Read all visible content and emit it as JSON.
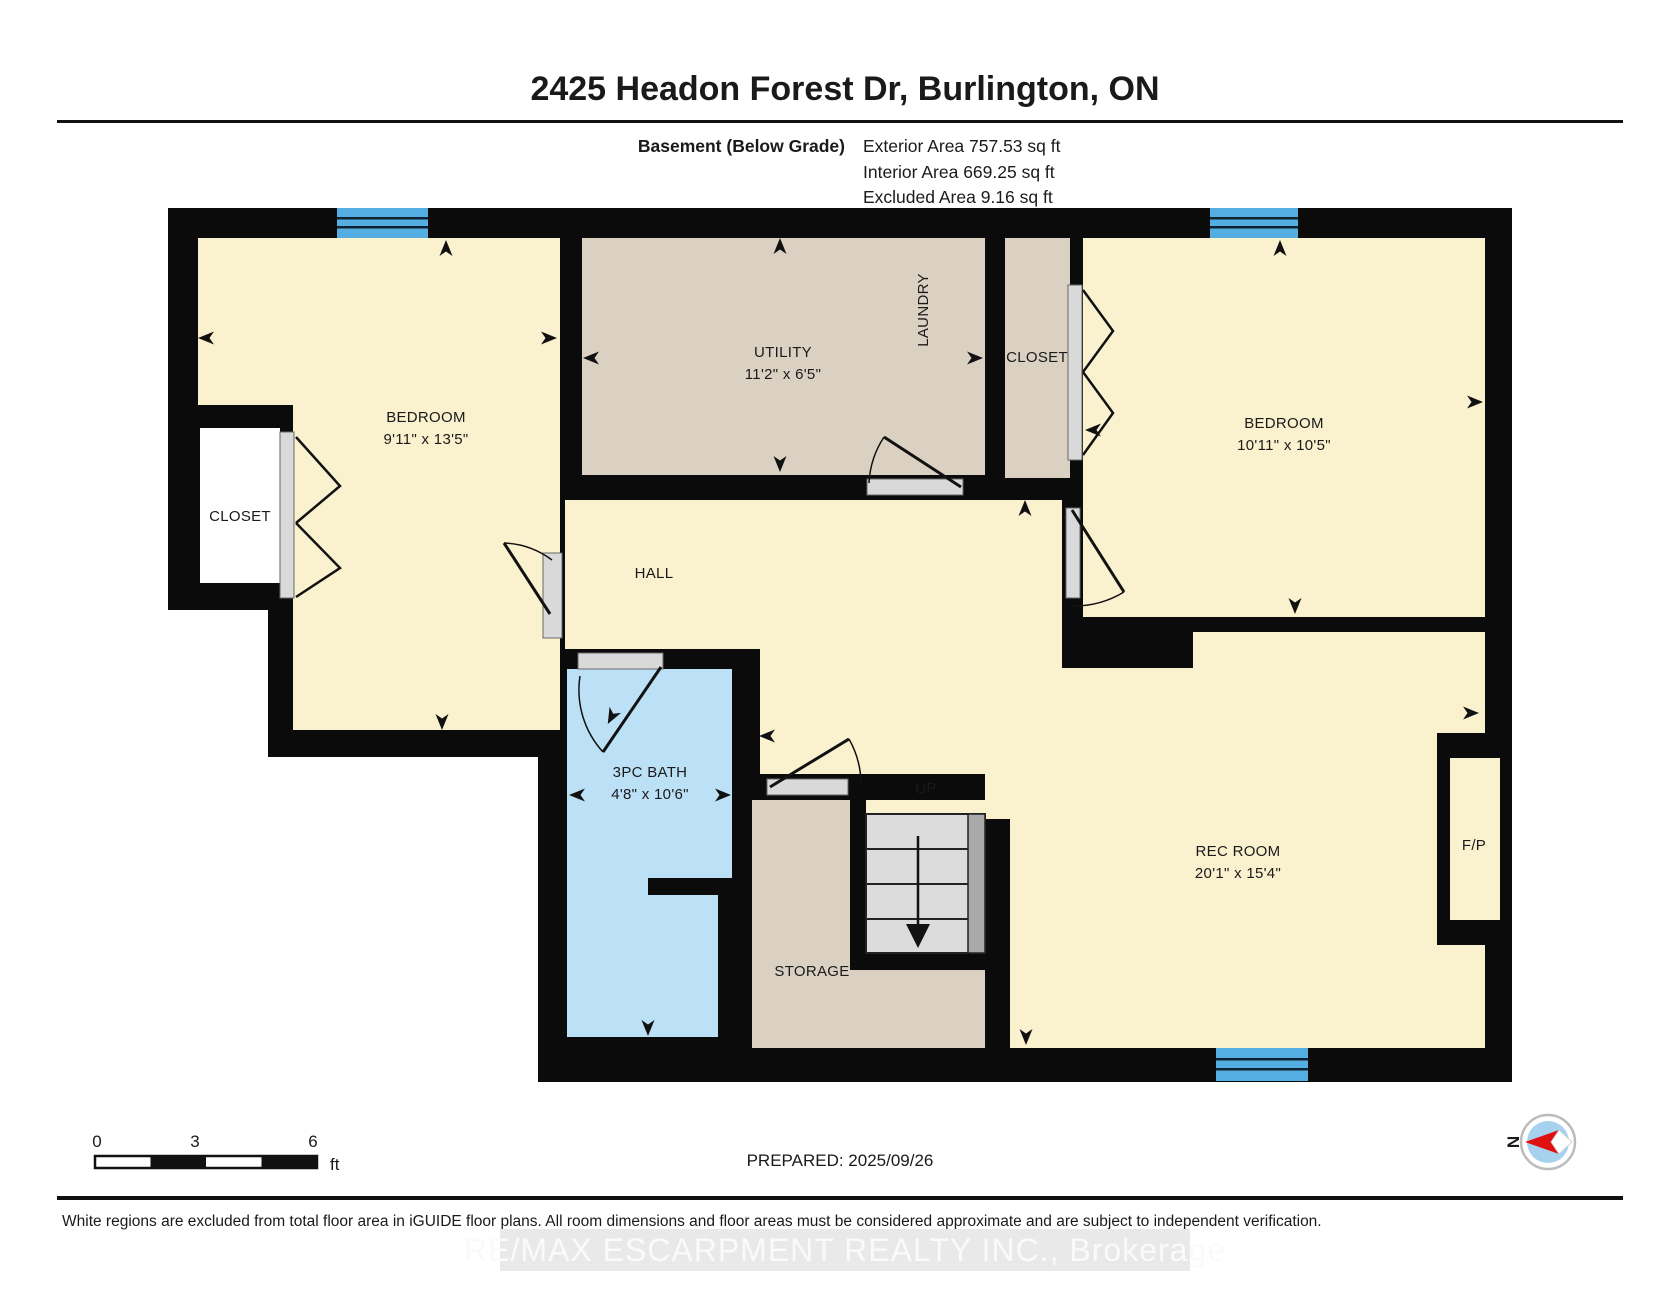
{
  "header": {
    "title": "2425 Headon Forest Dr, Burlington, ON",
    "floor_label": "Basement (Below Grade)",
    "exterior_area": "Exterior Area 757.53 sq ft",
    "interior_area": "Interior Area 669.25 sq ft",
    "excluded_area": "Excluded Area 9.16 sq ft"
  },
  "rooms": {
    "bedroom_left": {
      "name": "BEDROOM",
      "dims": "9'11\" x 13'5\""
    },
    "closet_left": {
      "name": "CLOSET"
    },
    "utility": {
      "name": "UTILITY",
      "dims": "11'2\" x 6'5\""
    },
    "laundry": {
      "name": "LAUNDRY"
    },
    "closet_center": {
      "name": "CLOSET"
    },
    "bedroom_right": {
      "name": "BEDROOM",
      "dims": "10'11\" x 10'5\""
    },
    "hall": {
      "name": "HALL"
    },
    "bath": {
      "name": "3PC BATH",
      "dims": "4'8\" x 10'6\""
    },
    "storage": {
      "name": "STORAGE"
    },
    "rec_room": {
      "name": "REC ROOM",
      "dims": "20'1\" x 15'4\""
    },
    "fireplace": {
      "name": "F/P"
    },
    "stairs": {
      "label": "UP"
    }
  },
  "footer": {
    "prepared": "PREPARED: 2025/09/26",
    "scale_ticks": [
      "0",
      "3",
      "6"
    ],
    "scale_unit": "ft",
    "compass": "N",
    "disclaimer": "White regions are excluded from total floor area in iGUIDE floor plans. All room dimensions and floor areas must be considered approximate and are subject to independent verification.",
    "watermark": "RE/MAX ESCARPMENT REALTY INC., Brokerage"
  },
  "colors": {
    "wall": "#0b0b0b",
    "room_cream": "#faf1cf",
    "room_tan": "#dad1c3",
    "room_blue": "#bce0f6",
    "window_blue": "#54aee1",
    "closet_white": "#ffffff",
    "stair_gray": "#dcdcdc",
    "stair_rail": "#a9a9a9",
    "door_track": "#d9d9d9",
    "compass_red": "#e01010",
    "compass_disc": "#a6d2ef"
  }
}
